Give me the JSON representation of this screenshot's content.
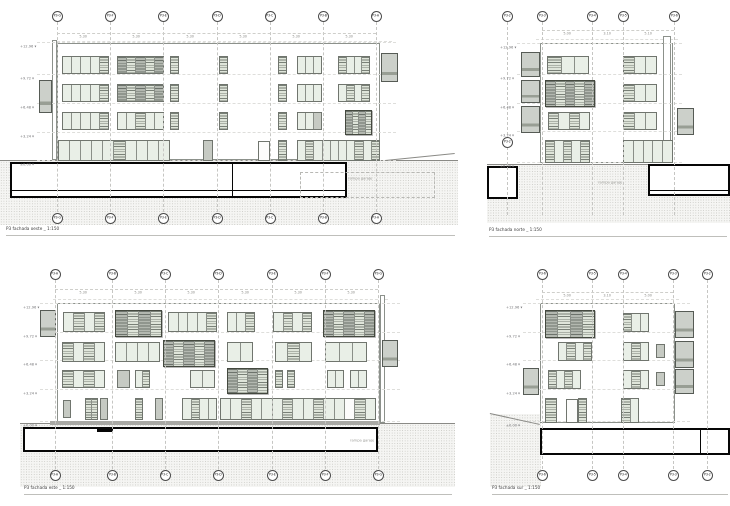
{
  "sheet": {
    "background": "#ffffff",
    "line_color": "#8c918b",
    "section_color": "#060606",
    "glass_color": "#e9efe7",
    "shutter_color": "#b3b8b0",
    "ground_color": "#f5f5f3"
  },
  "panels": [
    {
      "name": "elevation-top-left",
      "caption": "P3 fachada oeste _ 1:150",
      "grid": {
        "labels": [
          "P3-G",
          "P3-F",
          "P3-E",
          "P3-D",
          "P3-C",
          "P3-B",
          "P3-A"
        ],
        "xs": [
          57,
          110,
          163,
          217,
          270,
          323,
          376
        ],
        "top_y": 16,
        "bottom_y": 218,
        "line_top": 22,
        "line_bottom": 212
      },
      "dims": {
        "y": 33,
        "x1": 57,
        "x2": 376,
        "start": 0,
        "values": [
          "5.30",
          "5.30",
          "5.30",
          "5.30",
          "5.30",
          "5.30"
        ]
      },
      "levels": {
        "x": 20,
        "ys": [
          42,
          74,
          103,
          132,
          160
        ],
        "line_x2": 396,
        "labels": [
          "+12.96",
          "+9.72",
          "+6.48",
          "+3.24",
          "±0.00"
        ]
      },
      "roof_lines": [
        {
          "x": 52,
          "y": 41,
          "w": 340
        }
      ],
      "building": {
        "x": 57,
        "y": 43,
        "w": 323,
        "h": 117
      },
      "strips": [
        {
          "x": 52,
          "y": 40,
          "w": 5,
          "h": 120
        }
      ],
      "windows": [
        {
          "x": 62,
          "y": 56,
          "w": 47,
          "h": 18,
          "panes": "ggggl"
        },
        {
          "x": 117,
          "y": 56,
          "w": 47,
          "h": 18,
          "panes": "dldld"
        },
        {
          "x": 170,
          "y": 56,
          "w": 9,
          "h": 18,
          "panes": "l"
        },
        {
          "x": 219,
          "y": 56,
          "w": 9,
          "h": 18,
          "panes": "l"
        },
        {
          "x": 278,
          "y": 56,
          "w": 9,
          "h": 18,
          "panes": "l"
        },
        {
          "x": 297,
          "y": 56,
          "w": 25,
          "h": 18,
          "panes": "ggg"
        },
        {
          "x": 338,
          "y": 56,
          "w": 32,
          "h": 18,
          "panes": "lggl"
        },
        {
          "x": 62,
          "y": 84,
          "w": 47,
          "h": 18,
          "panes": "ggggl"
        },
        {
          "x": 117,
          "y": 84,
          "w": 47,
          "h": 18,
          "panes": "dldld"
        },
        {
          "x": 170,
          "y": 84,
          "w": 9,
          "h": 18,
          "panes": "l"
        },
        {
          "x": 219,
          "y": 84,
          "w": 9,
          "h": 18,
          "panes": "l"
        },
        {
          "x": 278,
          "y": 84,
          "w": 9,
          "h": 18,
          "panes": "l"
        },
        {
          "x": 297,
          "y": 84,
          "w": 25,
          "h": 18,
          "panes": "ggg"
        },
        {
          "x": 338,
          "y": 84,
          "w": 32,
          "h": 18,
          "panes": "glgl"
        },
        {
          "x": 62,
          "y": 112,
          "w": 47,
          "h": 18,
          "panes": "ggggl"
        },
        {
          "x": 117,
          "y": 112,
          "w": 47,
          "h": 18,
          "panes": "gglgg"
        },
        {
          "x": 170,
          "y": 112,
          "w": 9,
          "h": 18,
          "panes": "l"
        },
        {
          "x": 219,
          "y": 112,
          "w": 9,
          "h": 18,
          "panes": "l"
        },
        {
          "x": 278,
          "y": 112,
          "w": 9,
          "h": 18,
          "panes": "l"
        },
        {
          "x": 297,
          "y": 112,
          "w": 25,
          "h": 18,
          "panes": "ggs"
        },
        {
          "x": 345,
          "y": 110,
          "w": 27,
          "h": 25,
          "panes": "dldl",
          "big": true
        },
        {
          "x": 58,
          "y": 140,
          "w": 112,
          "h": 21,
          "panes": "ggggglgggg"
        },
        {
          "x": 203,
          "y": 140,
          "w": 10,
          "h": 21,
          "panes": "s"
        },
        {
          "x": 258,
          "y": 141,
          "w": 12,
          "h": 20,
          "panes": "w"
        },
        {
          "x": 278,
          "y": 140,
          "w": 9,
          "h": 21,
          "panes": "l"
        },
        {
          "x": 297,
          "y": 140,
          "w": 83,
          "h": 21,
          "panes": "glggggglgl"
        }
      ],
      "balconies": [
        {
          "x": 39,
          "y": 80,
          "w": 13,
          "h": 33
        },
        {
          "x": 381,
          "y": 53,
          "w": 17,
          "h": 29
        }
      ],
      "grounds": [
        {
          "x": 0,
          "y": 160,
          "w": 458,
          "h": 65,
          "line": true
        }
      ],
      "sections": [
        {
          "x": 10,
          "y": 162,
          "w": 337,
          "h": 36,
          "divider_x": 232,
          "inner_line_y": 190
        }
      ],
      "dashed_rects": [
        {
          "x": 300,
          "y": 172,
          "w": 135,
          "h": 26
        }
      ],
      "slopes": [
        {
          "x1": 385,
          "y1": 160,
          "x2": 455,
          "y2": 153
        }
      ],
      "annotations": [
        {
          "x": 348,
          "y": 169,
          "text": "rampa garaje"
        }
      ]
    },
    {
      "name": "elevation-top-right",
      "caption": "P3 fachada norte _ 1:150",
      "grid": {
        "labels": [
          "P3-2",
          "P3-3",
          "P3-4",
          "P3-5",
          "P3-6"
        ],
        "xs": [
          507,
          542,
          592,
          623,
          674
        ],
        "top_y": 16,
        "bottom_y": null,
        "line_top": 22,
        "line_bottom": 215
      },
      "extra_markers": [
        {
          "x": 507,
          "y": 142,
          "label": "P3-2"
        }
      ],
      "dims": {
        "y": 30,
        "x1": 542,
        "x2": 674,
        "start": 1,
        "values": [
          "5.00",
          "3.10",
          "5.10"
        ]
      },
      "levels": {
        "x": 500,
        "ys": [
          43,
          74,
          103,
          131,
          162
        ],
        "line_x2": 682,
        "labels": [
          "+12.96",
          "+9.72",
          "+6.48",
          "+3.24",
          "±0.00"
        ]
      },
      "roof_lines": [
        {
          "x": 536,
          "y": 39,
          "w": 142
        }
      ],
      "building": {
        "x": 540,
        "y": 43,
        "w": 133,
        "h": 120
      },
      "strips": [
        {
          "x": 663,
          "y": 36,
          "w": 8,
          "h": 127
        }
      ],
      "windows": [
        {
          "x": 547,
          "y": 56,
          "w": 42,
          "h": 18,
          "panes": "lgg"
        },
        {
          "x": 623,
          "y": 56,
          "w": 34,
          "h": 18,
          "panes": "lgg"
        },
        {
          "x": 545,
          "y": 80,
          "w": 50,
          "h": 27,
          "panes": "dldld",
          "big": true
        },
        {
          "x": 623,
          "y": 84,
          "w": 34,
          "h": 18,
          "panes": "lgg"
        },
        {
          "x": 548,
          "y": 112,
          "w": 42,
          "h": 18,
          "panes": "lglg"
        },
        {
          "x": 623,
          "y": 112,
          "w": 34,
          "h": 18,
          "panes": "lgg"
        },
        {
          "x": 545,
          "y": 140,
          "w": 45,
          "h": 23,
          "panes": "lglgl"
        },
        {
          "x": 623,
          "y": 140,
          "w": 50,
          "h": 23,
          "panes": "ggggg"
        }
      ],
      "balconies": [
        {
          "x": 521,
          "y": 52,
          "w": 19,
          "h": 25
        },
        {
          "x": 521,
          "y": 80,
          "w": 19,
          "h": 23
        },
        {
          "x": 521,
          "y": 106,
          "w": 19,
          "h": 27
        },
        {
          "x": 677,
          "y": 108,
          "w": 17,
          "h": 27
        }
      ],
      "grounds": [
        {
          "x": 487,
          "y": 164,
          "w": 243,
          "h": 59,
          "line": true
        }
      ],
      "sections": [
        {
          "x": 487,
          "y": 166,
          "w": 31,
          "h": 33
        },
        {
          "x": 648,
          "y": 164,
          "w": 82,
          "h": 32,
          "inner_line_y": 190
        }
      ],
      "dashed_rects": [],
      "slopes": [],
      "annotations": [
        {
          "x": 598,
          "y": 173,
          "text": "rampa garaje"
        }
      ]
    },
    {
      "name": "elevation-bottom-left",
      "caption": "P3 fachada este _ 1:150",
      "grid": {
        "labels": [
          "P3-A",
          "P3-B",
          "P3-C",
          "P3-D",
          "P3-E",
          "P3-F",
          "P3-G"
        ],
        "xs": [
          55,
          112,
          165,
          218,
          272,
          325,
          378
        ],
        "top_y": 274,
        "bottom_y": 475,
        "line_top": 280,
        "line_bottom": 469
      },
      "dims": {
        "y": 289,
        "x1": 55,
        "x2": 378,
        "start": 0,
        "values": [
          "5.30",
          "5.30",
          "5.30",
          "5.30",
          "5.30",
          "5.30"
        ]
      },
      "levels": {
        "x": 23,
        "ys": [
          303,
          332,
          360,
          389,
          421
        ],
        "line_x2": 400,
        "labels": [
          "+12.96",
          "+9.72",
          "+6.48",
          "+3.24",
          "±0.00"
        ]
      },
      "roof_lines": [
        {
          "x": 53,
          "y": 299,
          "w": 335
        }
      ],
      "building": {
        "x": 57,
        "y": 303,
        "w": 323,
        "h": 120
      },
      "strips": [
        {
          "x": 380,
          "y": 295,
          "w": 5,
          "h": 128
        }
      ],
      "windows": [
        {
          "x": 63,
          "y": 312,
          "w": 42,
          "h": 20,
          "panes": "glgl"
        },
        {
          "x": 115,
          "y": 310,
          "w": 47,
          "h": 27,
          "panes": "dldl",
          "big": true
        },
        {
          "x": 168,
          "y": 312,
          "w": 49,
          "h": 20,
          "panes": "ggggl"
        },
        {
          "x": 227,
          "y": 312,
          "w": 28,
          "h": 20,
          "panes": "ggl"
        },
        {
          "x": 273,
          "y": 312,
          "w": 39,
          "h": 20,
          "panes": "glgl"
        },
        {
          "x": 323,
          "y": 310,
          "w": 52,
          "h": 27,
          "panes": "dldld",
          "big": true
        },
        {
          "x": 62,
          "y": 342,
          "w": 43,
          "h": 20,
          "panes": "lglg"
        },
        {
          "x": 115,
          "y": 342,
          "w": 45,
          "h": 20,
          "panes": "gggg"
        },
        {
          "x": 163,
          "y": 340,
          "w": 52,
          "h": 27,
          "panes": "dldld",
          "big": true
        },
        {
          "x": 227,
          "y": 342,
          "w": 26,
          "h": 20,
          "panes": "gg"
        },
        {
          "x": 275,
          "y": 342,
          "w": 37,
          "h": 20,
          "panes": "glg"
        },
        {
          "x": 325,
          "y": 342,
          "w": 42,
          "h": 20,
          "panes": "ggg"
        },
        {
          "x": 62,
          "y": 370,
          "w": 43,
          "h": 18,
          "panes": "lglg"
        },
        {
          "x": 117,
          "y": 370,
          "w": 13,
          "h": 18,
          "panes": "s"
        },
        {
          "x": 135,
          "y": 370,
          "w": 15,
          "h": 18,
          "panes": "gl"
        },
        {
          "x": 190,
          "y": 370,
          "w": 25,
          "h": 18,
          "panes": "gg"
        },
        {
          "x": 227,
          "y": 368,
          "w": 41,
          "h": 26,
          "panes": "dldl",
          "big": true
        },
        {
          "x": 275,
          "y": 370,
          "w": 8,
          "h": 18,
          "panes": "l"
        },
        {
          "x": 287,
          "y": 370,
          "w": 8,
          "h": 18,
          "panes": "l"
        },
        {
          "x": 327,
          "y": 370,
          "w": 17,
          "h": 18,
          "panes": "gg"
        },
        {
          "x": 350,
          "y": 370,
          "w": 17,
          "h": 18,
          "panes": "gg"
        },
        {
          "x": 63,
          "y": 400,
          "w": 8,
          "h": 18,
          "panes": "s"
        },
        {
          "x": 85,
          "y": 398,
          "w": 13,
          "h": 22,
          "panes": "ll"
        },
        {
          "x": 100,
          "y": 398,
          "w": 8,
          "h": 22,
          "panes": "s"
        },
        {
          "x": 135,
          "y": 398,
          "w": 8,
          "h": 22,
          "panes": "l"
        },
        {
          "x": 155,
          "y": 398,
          "w": 8,
          "h": 22,
          "panes": "s"
        },
        {
          "x": 182,
          "y": 398,
          "w": 35,
          "h": 22,
          "panes": "glgg"
        },
        {
          "x": 220,
          "y": 398,
          "w": 156,
          "h": 22,
          "panes": "gglggglgglggwlg"
        }
      ],
      "balconies": [
        {
          "x": 40,
          "y": 310,
          "w": 16,
          "h": 27
        },
        {
          "x": 382,
          "y": 340,
          "w": 16,
          "h": 27
        }
      ],
      "grounds": [
        {
          "x": 20,
          "y": 423,
          "w": 435,
          "h": 64,
          "line": true
        }
      ],
      "bars": [
        {
          "x": 50,
          "y": 421,
          "w": 330,
          "h": 4,
          "color": "#a8a8a4"
        }
      ],
      "sections": [
        {
          "x": 23,
          "y": 427,
          "w": 355,
          "h": 25,
          "tab_x": 97
        }
      ],
      "dashed_rects": [],
      "slopes": [],
      "annotations": [
        {
          "x": 350,
          "y": 431,
          "text": "rampa garaje"
        }
      ]
    },
    {
      "name": "elevation-bottom-right",
      "caption": "P3 fachada sur _ 1:150",
      "grid": {
        "labels": [
          "P3-6",
          "P3-5",
          "P3-4",
          "P3-3",
          "P3-2"
        ],
        "xs": [
          542,
          592,
          623,
          673,
          707
        ],
        "top_y": 274,
        "bottom_y": 475,
        "line_top": 280,
        "line_bottom": 469
      },
      "dims": {
        "y": 292,
        "x1": 542,
        "x2": 673,
        "start": 0,
        "values": [
          "5.00",
          "3.10",
          "5.00"
        ]
      },
      "levels": {
        "x": 506,
        "ys": [
          303,
          332,
          360,
          389,
          421
        ],
        "line_x2": 690,
        "labels": [
          "+12.96",
          "+9.72",
          "+6.48",
          "+3.24",
          "±0.00"
        ]
      },
      "roof_lines": [
        {
          "x": 536,
          "y": 299,
          "w": 143
        }
      ],
      "building": {
        "x": 540,
        "y": 303,
        "w": 135,
        "h": 120
      },
      "strips": [],
      "windows": [
        {
          "x": 545,
          "y": 310,
          "w": 50,
          "h": 28,
          "panes": "dldl",
          "big": true
        },
        {
          "x": 623,
          "y": 313,
          "w": 26,
          "h": 19,
          "panes": "lgg"
        },
        {
          "x": 558,
          "y": 342,
          "w": 34,
          "h": 19,
          "panes": "glgl"
        },
        {
          "x": 623,
          "y": 342,
          "w": 26,
          "h": 19,
          "panes": "glg"
        },
        {
          "x": 656,
          "y": 344,
          "w": 9,
          "h": 14,
          "panes": "s"
        },
        {
          "x": 548,
          "y": 370,
          "w": 33,
          "h": 19,
          "panes": "lglg"
        },
        {
          "x": 623,
          "y": 370,
          "w": 26,
          "h": 19,
          "panes": "glg"
        },
        {
          "x": 656,
          "y": 372,
          "w": 9,
          "h": 14,
          "panes": "s"
        },
        {
          "x": 545,
          "y": 398,
          "w": 12,
          "h": 25,
          "panes": "l"
        },
        {
          "x": 566,
          "y": 399,
          "w": 12,
          "h": 24,
          "panes": "w"
        },
        {
          "x": 578,
          "y": 398,
          "w": 9,
          "h": 25,
          "panes": "l"
        },
        {
          "x": 621,
          "y": 398,
          "w": 18,
          "h": 25,
          "panes": "lg"
        }
      ],
      "balconies": [
        {
          "x": 675,
          "y": 311,
          "w": 19,
          "h": 27
        },
        {
          "x": 675,
          "y": 341,
          "w": 19,
          "h": 27
        },
        {
          "x": 675,
          "y": 369,
          "w": 19,
          "h": 25
        },
        {
          "x": 523,
          "y": 368,
          "w": 16,
          "h": 27
        }
      ],
      "grounds": [
        {
          "x": 490,
          "y": 414,
          "w": 51,
          "h": 73,
          "line": false
        }
      ],
      "sections": [
        {
          "x": 540,
          "y": 428,
          "w": 190,
          "h": 27,
          "divider_x": 700
        }
      ],
      "dashed_rects": [],
      "slopes": [
        {
          "x1": 490,
          "y1": 413,
          "x2": 540,
          "y2": 424
        }
      ],
      "annotations": []
    }
  ]
}
